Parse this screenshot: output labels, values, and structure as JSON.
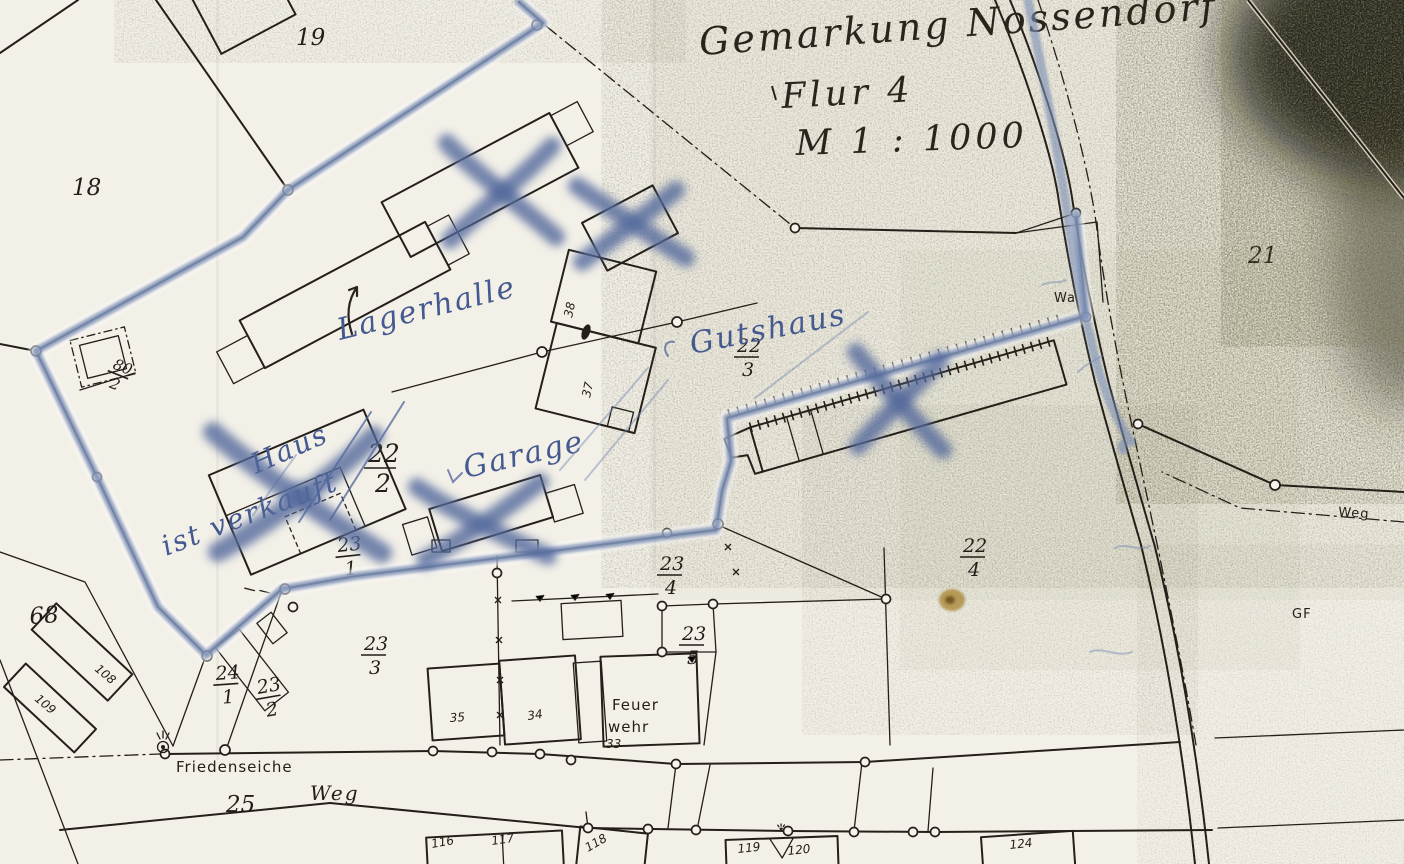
{
  "handwriting_header": {
    "line1": "Gemarkung Nossendorf",
    "line2": "Flur 4",
    "line3": "M 1 : 1000"
  },
  "annotations_blue": {
    "lagerhalle": "Lagerhalle",
    "gutshaus": "Gutshaus",
    "garage": "Garage",
    "haus": "Haus",
    "ist_verkauft": "ist verkauft"
  },
  "parcel_numbers": {
    "p18": "18",
    "p19": "19",
    "p21": "21",
    "p25": "25",
    "p68": "68"
  },
  "parcel_fractions": {
    "p80_2": {
      "num": "80",
      "den": "2"
    },
    "p22_2": {
      "num": "22",
      "den": "2"
    },
    "p22_3": {
      "num": "22",
      "den": "3"
    },
    "p22_4": {
      "num": "22",
      "den": "4"
    },
    "p23_1": {
      "num": "23",
      "den": "1"
    },
    "p23_2": {
      "num": "23",
      "den": "2"
    },
    "p23_3": {
      "num": "23",
      "den": "3"
    },
    "p23_4": {
      "num": "23",
      "den": "4"
    },
    "p23_5": {
      "num": "23",
      "den": "5"
    },
    "p24_1": {
      "num": "24",
      "den": "1"
    }
  },
  "building_numbers": {
    "b33": "33",
    "b34": "34",
    "b35": "35",
    "b37": "37",
    "b38": "38",
    "b108": "108",
    "b109": "109",
    "b116": "116",
    "b117": "117",
    "b118": "118",
    "b119": "119",
    "b120": "120",
    "b124": "124"
  },
  "labels": {
    "feuerwehr_line1": "Feuer",
    "feuerwehr_line2": "wehr",
    "friedenseiche": "Friedenseiche",
    "weg_bottom": "Weg",
    "weg_right": "Weg",
    "wa": "Wa",
    "gf": "GF"
  },
  "colors": {
    "paper": "#f3f0e8",
    "ink": "#241f18",
    "blue_pen": "#44598f",
    "blue_marker": "#7b8eb4",
    "toner_dark": "#17140c",
    "stain": "#a5812f"
  }
}
